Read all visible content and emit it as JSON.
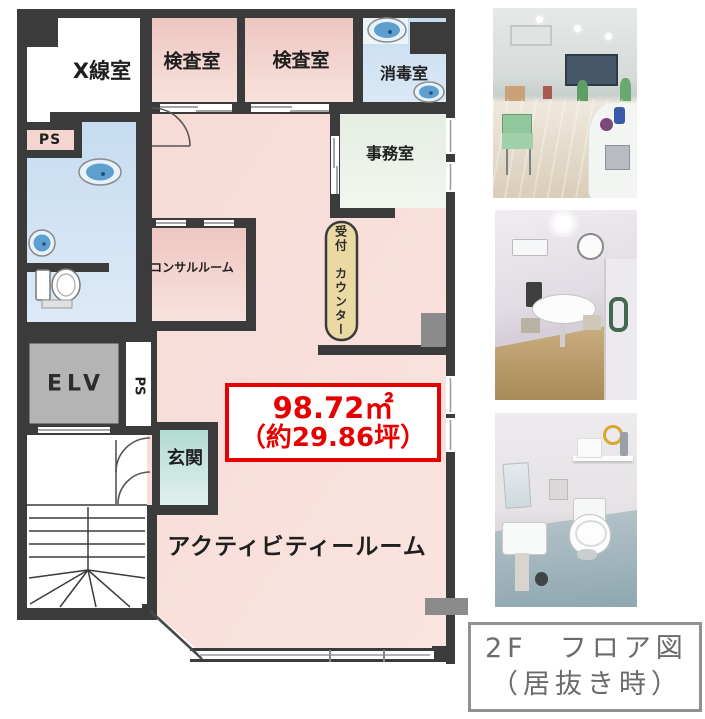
{
  "floor_plan": {
    "rooms": {
      "xray": "X線室",
      "exam1": "検査室",
      "exam2": "検査室",
      "disinfection": "消毒室",
      "office": "事務室",
      "ps_top": "PS",
      "consult": "コンサルルーム",
      "reception": "受付　カウンター",
      "elevator": "ELV",
      "ps_side": "PS",
      "entrance": "玄関",
      "activity": "アクティビティールーム"
    },
    "area_box": {
      "line1": "98.72㎡",
      "line2": "（約29.86坪）"
    },
    "fixtures": [
      "sink-icon",
      "sink-icon",
      "sink-icon",
      "sink-icon",
      "toilet-icon",
      "stairs-icon",
      "door-swing-icon"
    ],
    "colors": {
      "wall": "#3b3b3b",
      "room_pink": "#efc8c2",
      "hall_pink": "#f8ddd8",
      "wet_blue": "#cfe1f1",
      "office_green": "#eaf1e8",
      "entrance_teal": "#bfe0d9",
      "elevator_gray": "#b4b4b4",
      "reception_beige": "#ead9a2",
      "area_red": "#e60000",
      "caption_gray": "#6b6b6b"
    }
  },
  "caption": {
    "line1": "2F　フロア図",
    "line2": "（居抜き時）"
  },
  "photos": {
    "top": "activity-room-interior-photo",
    "middle": "consultation-room-interior-photo",
    "bottom": "toilet-room-interior-photo"
  }
}
